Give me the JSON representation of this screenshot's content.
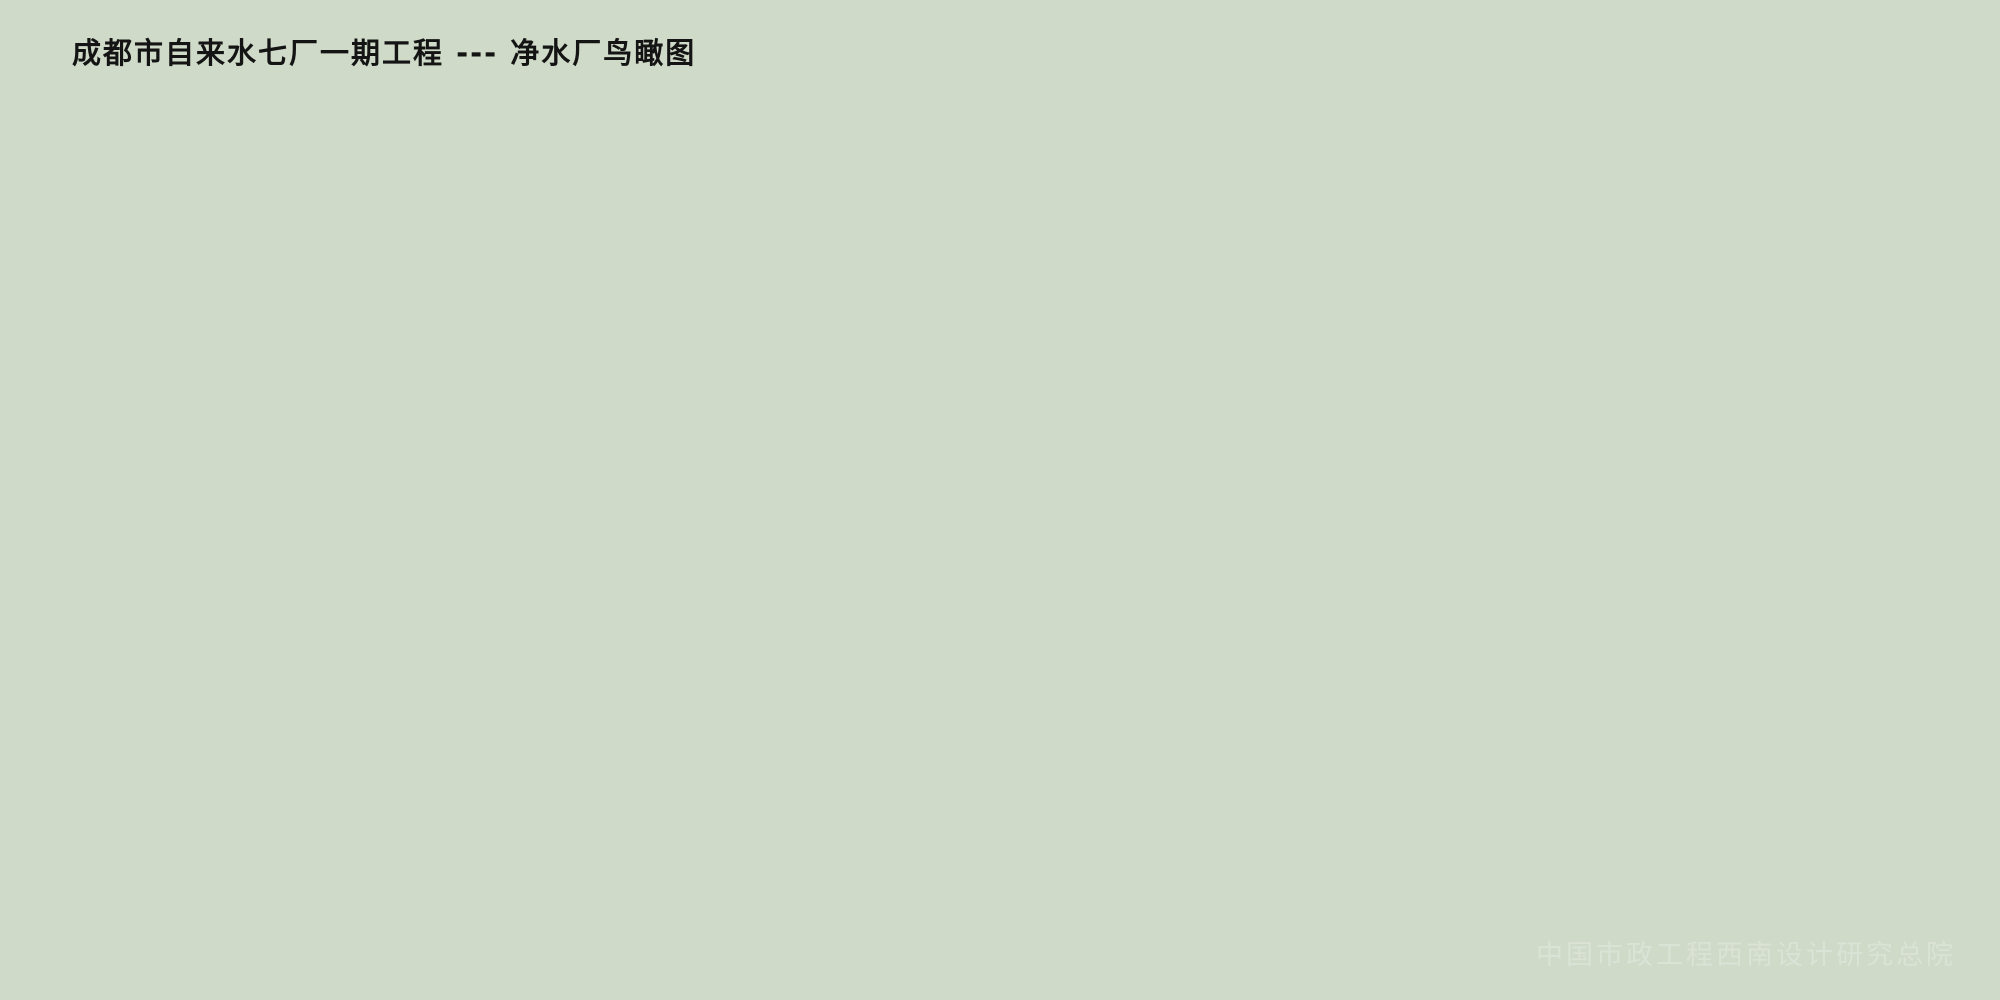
{
  "title": "成都市自来水七厂一期工程 --- 净水厂鸟瞰图",
  "watermark": "中国市政工程西南设计研究总院",
  "scene": {
    "type": "aerial-architectural-rendering",
    "subject": "water-purification-plant",
    "regions": [
      "countryside-background",
      "distant-village",
      "main-road",
      "plant-site",
      "sedimentation-basins",
      "filter-channels",
      "circular-clarifiers",
      "arched-workshops",
      "admin-buildings",
      "orchard-forest",
      "lawn-garden",
      "office-complex",
      "dormitory-garages",
      "boundary-hedges"
    ]
  },
  "palette": {
    "background_haze": "#e9f0e7",
    "field_yellow": "#d8d99a",
    "field_green": "#8fae6e",
    "field_dark": "#4d7747",
    "site_green": "#a8c07f",
    "water": "#3ea6d8",
    "water_deep": "#2e93c8",
    "basin_frame": "#e8dbae",
    "concrete": "#ece1bf",
    "roof_beige": "#e9d9ba",
    "roof_pink": "#e3c3a6",
    "wall_shade": "#c0ad8c",
    "arch_roof_light": "#e8eef4",
    "arch_roof_dark": "#7e93ab",
    "building_white": "#f4f4ef",
    "glass": "#7f9cb8",
    "tree_green": "#4e8236",
    "tree_yellow": "#d2b23f",
    "tree_orange": "#c9852f",
    "tree_red": "#ad5632",
    "road": "#9aa49c",
    "road_line_yellow": "#d9b84e",
    "path": "#eef0e2",
    "lawn": "#97b15c",
    "court_pink": "#dfa38f",
    "title_color": "#141414",
    "watermark_color": "#dde4d8"
  }
}
